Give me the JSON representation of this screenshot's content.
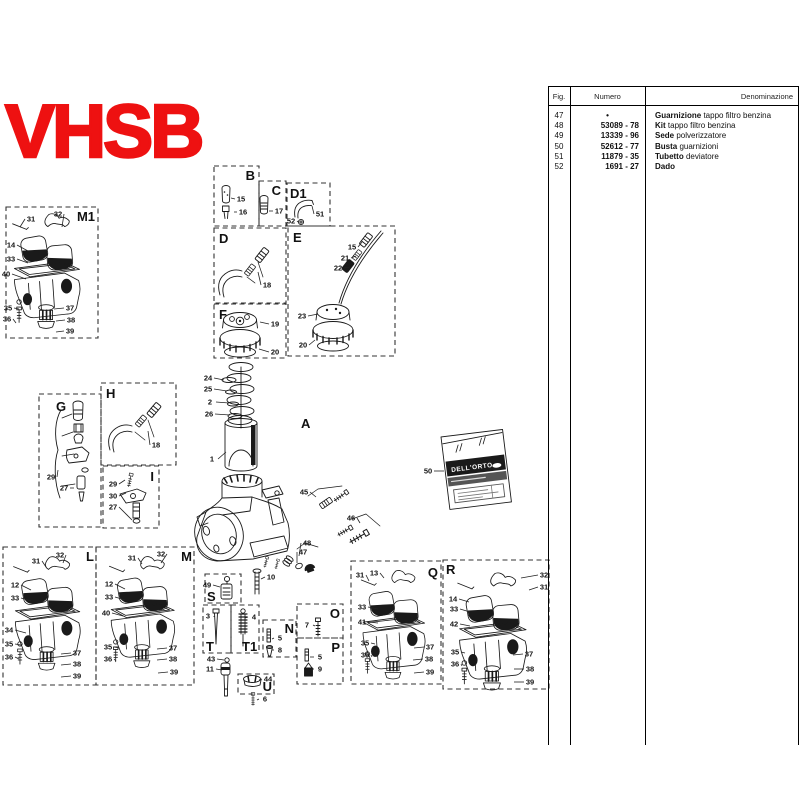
{
  "title": "VHSB",
  "colors": {
    "accent": "#ee1111",
    "ink": "#1a1a1a"
  },
  "packet": {
    "brand": "DELL'ORTO",
    "fig": "50"
  },
  "table": {
    "headers": {
      "fig": "Fig.",
      "numero": "Numero",
      "denominazione": "Denominazione"
    },
    "rows": [
      {
        "fig": "47",
        "numero": "•",
        "den_bold": "Guarnizione",
        "den_rest": "tappo filtro benzina"
      },
      {
        "fig": "48",
        "numero": "53089 - 78",
        "den_bold": "Kit",
        "den_rest": "tappo filtro benzina"
      },
      {
        "fig": "49",
        "numero": "13339 - 96",
        "den_bold": "Sede",
        "den_rest": "polverizzatore"
      },
      {
        "fig": "50",
        "numero": "52612 - 77",
        "den_bold": "Busta",
        "den_rest": "guarnizioni"
      },
      {
        "fig": "51",
        "numero": "11879 - 35",
        "den_bold": "Tubetto",
        "den_rest": "deviatore"
      },
      {
        "fig": "52",
        "numero": "1691 - 27",
        "den_bold": "Dado",
        "den_rest": ""
      }
    ]
  },
  "diagram": {
    "sections": [
      {
        "label": "M1",
        "box": [
          6,
          207,
          92,
          131
        ],
        "lx": 95,
        "ly": 221,
        "anchor": "end"
      },
      {
        "label": "B",
        "box": [
          214,
          166,
          45,
          60
        ],
        "lx": 255,
        "ly": 180,
        "anchor": "end"
      },
      {
        "label": "C",
        "box": [
          259,
          181,
          27,
          45
        ],
        "lx": 281,
        "ly": 195,
        "anchor": "end"
      },
      {
        "label": "D1",
        "box": [
          287,
          183,
          43,
          43
        ],
        "lx": 290,
        "ly": 198,
        "anchor": "start"
      },
      {
        "label": "D",
        "box": [
          214,
          228,
          72,
          75
        ],
        "lx": 219,
        "ly": 243,
        "anchor": "start"
      },
      {
        "label": "E",
        "box": [
          288,
          226,
          107,
          130
        ],
        "lx": 293,
        "ly": 242,
        "anchor": "start"
      },
      {
        "label": "F",
        "box": [
          214,
          304,
          72,
          54
        ],
        "lx": 219,
        "ly": 319,
        "anchor": "start"
      },
      {
        "label": "G",
        "box": [
          39,
          394,
          62,
          133
        ],
        "lx": 56,
        "ly": 411,
        "anchor": "start"
      },
      {
        "label": "H",
        "box": [
          101,
          383,
          75,
          82
        ],
        "lx": 106,
        "ly": 398,
        "anchor": "start"
      },
      {
        "label": "I",
        "box": [
          103,
          466,
          56,
          62
        ],
        "lx": 154,
        "ly": 481,
        "anchor": "end"
      },
      {
        "label": "A",
        "box": null,
        "lx": 301,
        "ly": 428,
        "anchor": "start",
        "size": 24
      },
      {
        "label": "L",
        "box": [
          3,
          547,
          93,
          138
        ],
        "lx": 94,
        "ly": 561,
        "anchor": "end"
      },
      {
        "label": "M",
        "box": [
          96,
          547,
          98,
          138
        ],
        "lx": 192,
        "ly": 561,
        "anchor": "end"
      },
      {
        "label": "S",
        "box": [
          205,
          574,
          36,
          29
        ],
        "lx": 207,
        "ly": 601,
        "anchor": "start",
        "size": 12
      },
      {
        "label": "T",
        "box": [
          203,
          605,
          28,
          48
        ],
        "lx": 206,
        "ly": 651,
        "anchor": "start",
        "size": 12
      },
      {
        "label": "T1",
        "box": [
          231,
          605,
          28,
          48
        ],
        "lx": 242,
        "ly": 651,
        "anchor": "start",
        "size": 12
      },
      {
        "label": "N",
        "box": [
          263,
          620,
          33,
          37
        ],
        "lx": 294,
        "ly": 633,
        "anchor": "end",
        "size": 12
      },
      {
        "label": "O",
        "box": [
          297,
          604,
          46,
          34
        ],
        "lx": 340,
        "ly": 618,
        "anchor": "end",
        "size": 13
      },
      {
        "label": "P",
        "box": [
          297,
          638,
          46,
          46
        ],
        "lx": 340,
        "ly": 652,
        "anchor": "end",
        "size": 13
      },
      {
        "label": "U",
        "box": [
          238,
          674,
          36,
          20
        ],
        "lx": 272,
        "ly": 691,
        "anchor": "end",
        "size": 12
      },
      {
        "label": "Q",
        "box": [
          351,
          561,
          90,
          123
        ],
        "lx": 438,
        "ly": 577,
        "anchor": "end"
      },
      {
        "label": "R",
        "box": [
          443,
          560,
          106,
          129
        ],
        "lx": 446,
        "ly": 574,
        "anchor": "start"
      }
    ],
    "callouts": [
      [
        "31",
        31,
        219,
        20,
        227
      ],
      [
        "32",
        58,
        214,
        62,
        227
      ],
      [
        "14",
        11,
        245,
        28,
        251
      ],
      [
        "33",
        11,
        259,
        28,
        263
      ],
      [
        "40",
        6,
        274,
        26,
        279
      ],
      [
        "35",
        8,
        308,
        19,
        309
      ],
      [
        "36",
        7,
        319,
        16,
        323
      ],
      [
        "37",
        70,
        308,
        54,
        309
      ],
      [
        "38",
        71,
        320,
        56,
        321
      ],
      [
        "39",
        70,
        331,
        56,
        332
      ],
      [
        "15",
        241,
        199,
        231,
        198
      ],
      [
        "16",
        243,
        212,
        234,
        212
      ],
      [
        "17",
        279,
        211,
        269,
        211
      ],
      [
        "51",
        320,
        214,
        312,
        206
      ],
      [
        "52",
        291,
        221,
        298,
        222
      ],
      [
        "18",
        267,
        285,
        258,
        272
      ],
      [
        "15",
        352,
        247,
        362,
        242
      ],
      [
        "21",
        345,
        258,
        356,
        256
      ],
      [
        "22",
        338,
        268,
        350,
        267
      ],
      [
        "23",
        302,
        316,
        318,
        314
      ],
      [
        "20",
        303,
        345,
        315,
        340
      ],
      [
        "19",
        275,
        324,
        260,
        322
      ],
      [
        "20",
        275,
        352,
        259,
        349
      ],
      [
        "24",
        208,
        378,
        224,
        380
      ],
      [
        "25",
        208,
        389,
        227,
        391
      ],
      [
        "2",
        210,
        402,
        229,
        403
      ],
      [
        "26",
        209,
        414,
        230,
        415
      ],
      [
        "1",
        212,
        459,
        226,
        452
      ],
      [
        "29",
        51,
        477,
        58,
        470
      ],
      [
        "27",
        64,
        488,
        74,
        488
      ],
      [
        "18",
        156,
        445,
        148,
        431
      ],
      [
        "29",
        113,
        484,
        125,
        480
      ],
      [
        "30",
        113,
        496,
        126,
        493
      ],
      [
        "27",
        113,
        507,
        132,
        520
      ],
      [
        "45",
        304,
        492,
        316,
        497
      ],
      [
        "46",
        351,
        518,
        360,
        523
      ],
      [
        "48",
        307,
        543,
        299,
        556
      ],
      [
        "47",
        303,
        552,
        297,
        563
      ],
      [
        "10",
        271,
        577,
        261,
        579
      ],
      [
        "50",
        428,
        471,
        444,
        471
      ],
      [
        "49",
        207,
        585,
        220,
        587
      ],
      [
        "3",
        208,
        616,
        214,
        617
      ],
      [
        "4",
        254,
        617,
        245,
        618
      ],
      [
        "5",
        280,
        638,
        272,
        639
      ],
      [
        "8",
        280,
        650,
        272,
        650
      ],
      [
        "7",
        307,
        625,
        315,
        626
      ],
      [
        "5",
        320,
        657,
        310,
        657
      ],
      [
        "9",
        320,
        669,
        311,
        669
      ],
      [
        "43",
        211,
        659,
        224,
        660
      ],
      [
        "11",
        210,
        669,
        222,
        670
      ],
      [
        "44",
        268,
        679,
        259,
        680
      ],
      [
        "6",
        265,
        699,
        257,
        700
      ],
      [
        "31",
        36,
        561,
        46,
        567
      ],
      [
        "32",
        60,
        555,
        63,
        563
      ],
      [
        "12",
        15,
        585,
        31,
        590
      ],
      [
        "33",
        15,
        598,
        31,
        601
      ],
      [
        "34",
        9,
        630,
        26,
        633
      ],
      [
        "35",
        9,
        644,
        21,
        645
      ],
      [
        "36",
        9,
        657,
        19,
        659
      ],
      [
        "37",
        77,
        653,
        61,
        654
      ],
      [
        "38",
        77,
        664,
        61,
        665
      ],
      [
        "39",
        77,
        676,
        61,
        677
      ],
      [
        "31",
        132,
        558,
        142,
        564
      ],
      [
        "32",
        161,
        554,
        161,
        563
      ],
      [
        "12",
        109,
        584,
        125,
        589
      ],
      [
        "33",
        109,
        597,
        125,
        600
      ],
      [
        "40",
        106,
        613,
        123,
        616
      ],
      [
        "35",
        108,
        647,
        119,
        648
      ],
      [
        "36",
        108,
        659,
        116,
        661
      ],
      [
        "37",
        173,
        648,
        157,
        649
      ],
      [
        "38",
        173,
        659,
        157,
        660
      ],
      [
        "39",
        174,
        672,
        158,
        673
      ],
      [
        "31",
        360,
        575,
        369,
        581
      ],
      [
        "13",
        374,
        573,
        384,
        578
      ],
      [
        "33",
        362,
        607,
        378,
        609
      ],
      [
        "41",
        362,
        622,
        378,
        623
      ],
      [
        "35",
        365,
        643,
        375,
        644
      ],
      [
        "36",
        365,
        655,
        372,
        657
      ],
      [
        "37",
        430,
        647,
        414,
        648
      ],
      [
        "38",
        429,
        659,
        413,
        660
      ],
      [
        "39",
        430,
        672,
        414,
        673
      ],
      [
        "32",
        544,
        575,
        521,
        578
      ],
      [
        "31",
        544,
        587,
        529,
        590
      ],
      [
        "14",
        453,
        599,
        469,
        602
      ],
      [
        "33",
        454,
        609,
        470,
        612
      ],
      [
        "42",
        454,
        624,
        470,
        626
      ],
      [
        "35",
        455,
        652,
        465,
        653
      ],
      [
        "36",
        455,
        664,
        462,
        666
      ],
      [
        "37",
        529,
        654,
        513,
        655
      ],
      [
        "38",
        530,
        669,
        514,
        669
      ],
      [
        "39",
        530,
        682,
        514,
        682
      ]
    ]
  }
}
